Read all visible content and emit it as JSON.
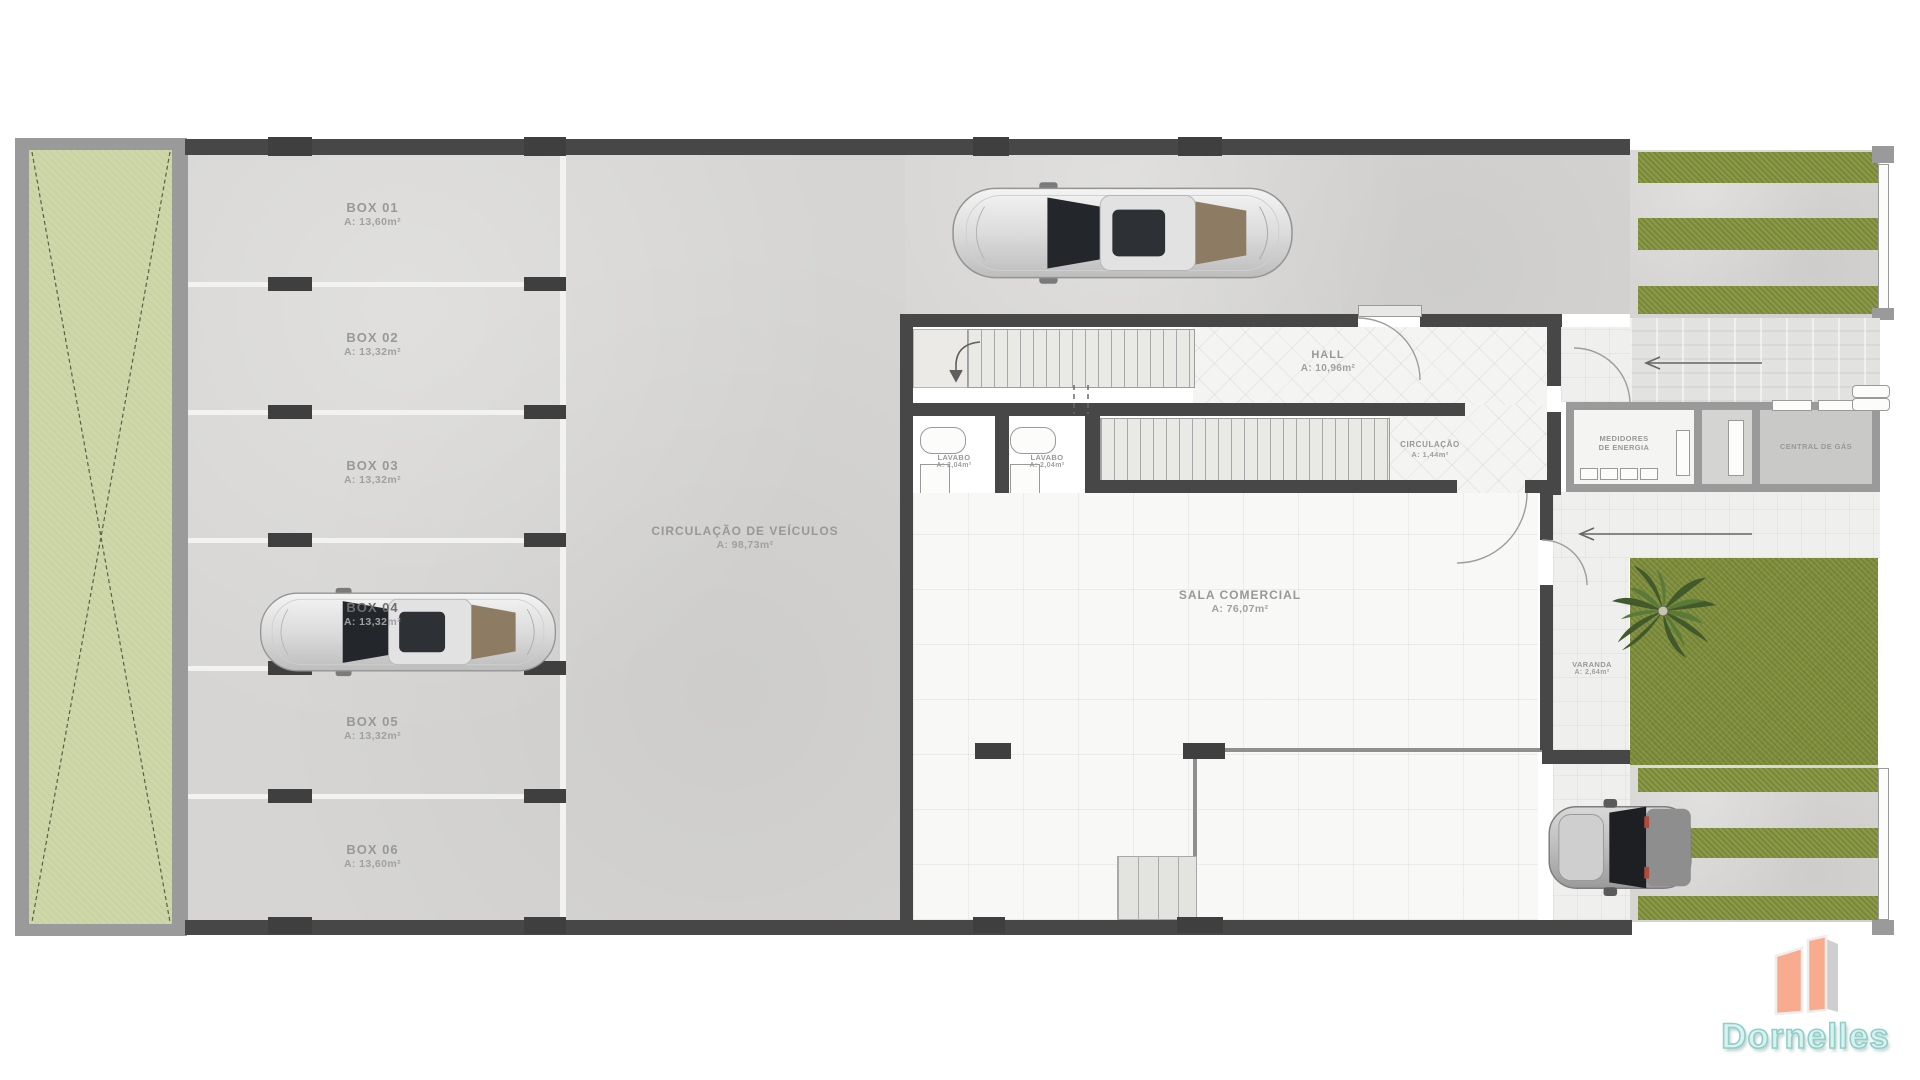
{
  "plan": {
    "boxes": [
      {
        "name": "BOX 01",
        "area": "A: 13,60m²"
      },
      {
        "name": "BOX 02",
        "area": "A: 13,32m²"
      },
      {
        "name": "BOX 03",
        "area": "A: 13,32m²"
      },
      {
        "name": "BOX 04",
        "area": "A: 13,32m²"
      },
      {
        "name": "BOX 05",
        "area": "A: 13,32m²"
      },
      {
        "name": "BOX 06",
        "area": "A: 13,60m²"
      }
    ],
    "vehicle_circulation": {
      "name": "CIRCULAÇÃO DE VEÍCULOS",
      "area": "A: 98,73m²"
    },
    "hall": {
      "name": "HALL",
      "area": "A: 10,96m²"
    },
    "stair_circulation": {
      "name": "CIRCULAÇÃO",
      "area": "A: 1,44m²"
    },
    "lavabo_1": {
      "name": "LAVABO",
      "area": "A: 2,04m²"
    },
    "lavabo_2": {
      "name": "LAVABO",
      "area": "A: 2,04m²"
    },
    "sala_comercial": {
      "name": "SALA COMERCIAL",
      "area": "A: 76,07m²"
    },
    "medidores": {
      "line1": "MEDIDORES",
      "line2": "DE ENERGIA"
    },
    "central_gas": {
      "name": "CENTRAL DE GÁS"
    },
    "varanda": {
      "name": "VARANDA",
      "area": "A: 2,64m²"
    }
  },
  "logo": {
    "text": "Dornelles"
  },
  "colors": {
    "wall_dark": "#474747",
    "wall_gray": "#9a9a9a",
    "concrete": "#d6d5d3",
    "green_strip": "#ced7a8",
    "grass": "#82923f",
    "logo_building": "#f8ab8e",
    "logo_text": "#d9f2ef"
  }
}
